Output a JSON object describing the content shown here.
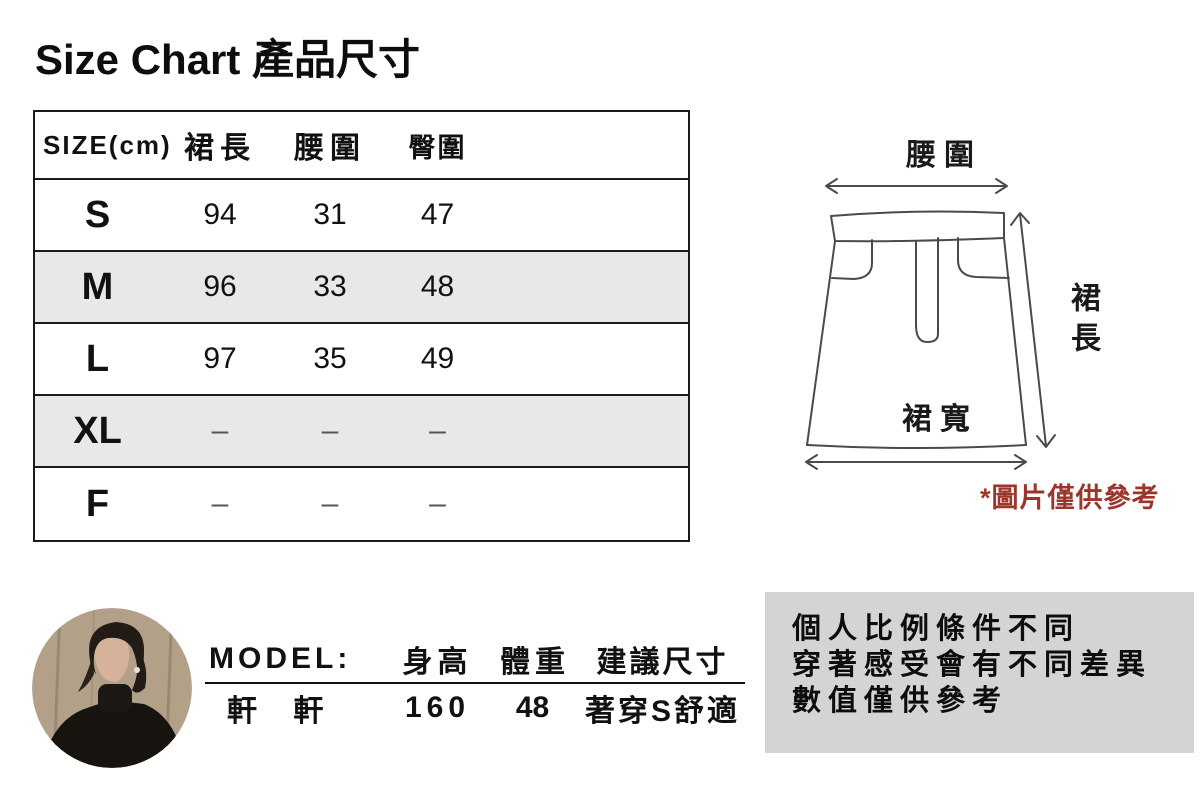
{
  "title": "Size Chart 產品尺寸",
  "size_table": {
    "size_header": "SIZE(cm)",
    "columns": [
      "裙長",
      "腰圍",
      "臀圍"
    ],
    "rows": [
      {
        "size": "S",
        "values": [
          "94",
          "31",
          "47"
        ]
      },
      {
        "size": "M",
        "values": [
          "96",
          "33",
          "48"
        ]
      },
      {
        "size": "L",
        "values": [
          "97",
          "35",
          "49"
        ]
      },
      {
        "size": "XL",
        "values": [
          "–",
          "–",
          "–"
        ]
      },
      {
        "size": "F",
        "values": [
          "–",
          "–",
          "–"
        ]
      }
    ]
  },
  "diagram": {
    "waist_label": "腰圍",
    "length_label": "裙長",
    "width_label": "裙寬",
    "note": "*圖片僅供參考"
  },
  "model_info": {
    "label": "MODEL:",
    "col_height": "身高",
    "col_weight": "體重",
    "col_suggest": "建議尺寸",
    "name": "軒 軒",
    "height": "160",
    "weight": "48",
    "suggestion": "著穿S舒適"
  },
  "disclaimer": {
    "line1": "個人比例條件不同",
    "line2": "穿著感受會有不同差異",
    "line3": "數值僅供參考"
  },
  "colors": {
    "shaded_row": "#e9e8e8",
    "disclaimer_bg": "#d6d4d2",
    "note_red": "#9c352b",
    "diagram_line": "#4a4a4a"
  },
  "chart_data": {
    "type": "table",
    "title": "Size Chart 產品尺寸",
    "unit": "cm",
    "columns": [
      "SIZE",
      "裙長",
      "腰圍",
      "臀圍"
    ],
    "rows": [
      [
        "S",
        94,
        31,
        47
      ],
      [
        "M",
        96,
        33,
        48
      ],
      [
        "L",
        97,
        35,
        49
      ],
      [
        "XL",
        null,
        null,
        null
      ],
      [
        "F",
        null,
        null,
        null
      ]
    ]
  }
}
